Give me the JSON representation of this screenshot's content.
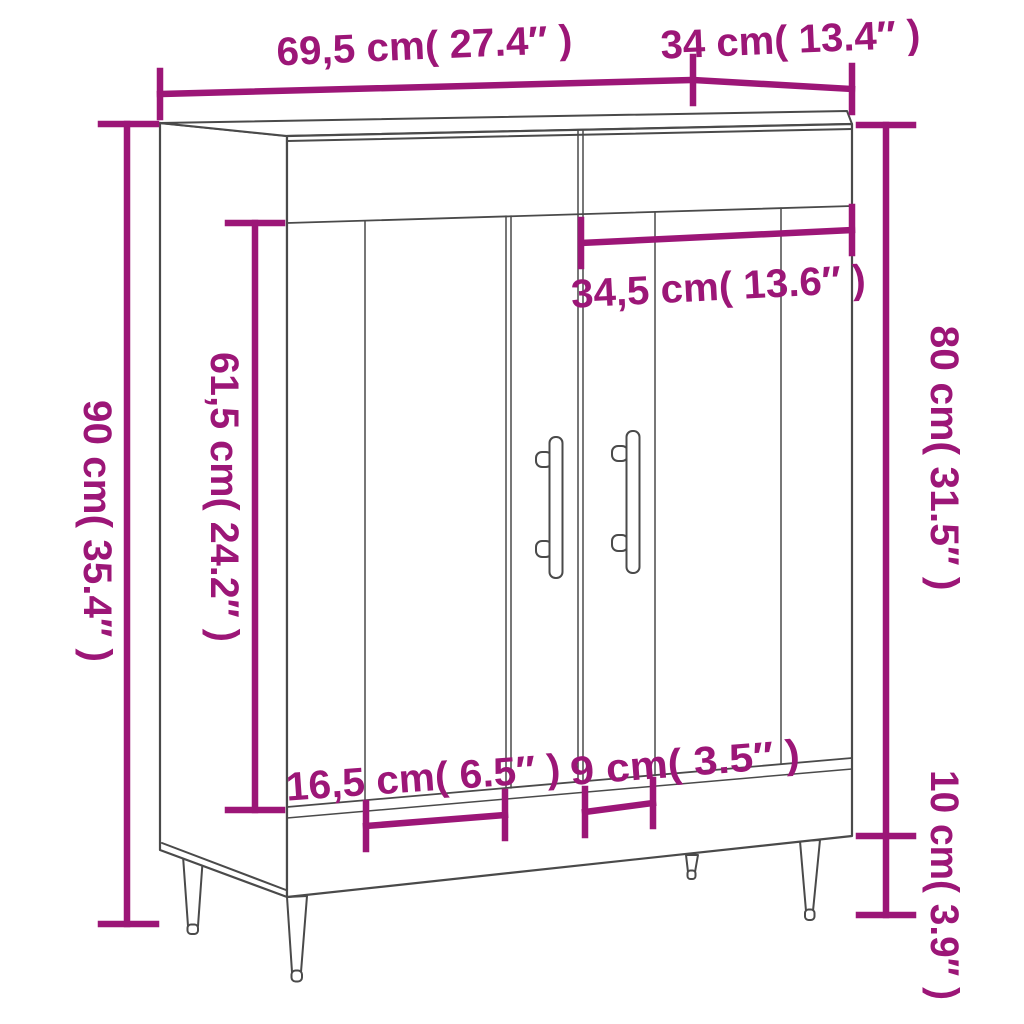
{
  "diagram": {
    "kind": "furniture-dimension-diagram",
    "subject": "sideboard-with-2-doors",
    "background_color": "#ffffff",
    "outline_color": "#4a4a4a",
    "accent_color": "#9C1677",
    "labels": {
      "top_width": "69,5 cm( 27.4″ )",
      "top_depth": "34 cm( 13.4″ )",
      "overall_height": "90 cm( 35.4″ )",
      "door_height": "61,5 cm( 24.2″ )",
      "door_width": "34,5 cm( 13.6″ )",
      "body_height": "80 cm( 31.5″ )",
      "leg_height": "10 cm( 3.9″ )",
      "left_door_groove_spacing": "16,5 cm( 6.5″ )",
      "right_door_groove_spacing": "9 cm( 3.5″ )"
    }
  }
}
